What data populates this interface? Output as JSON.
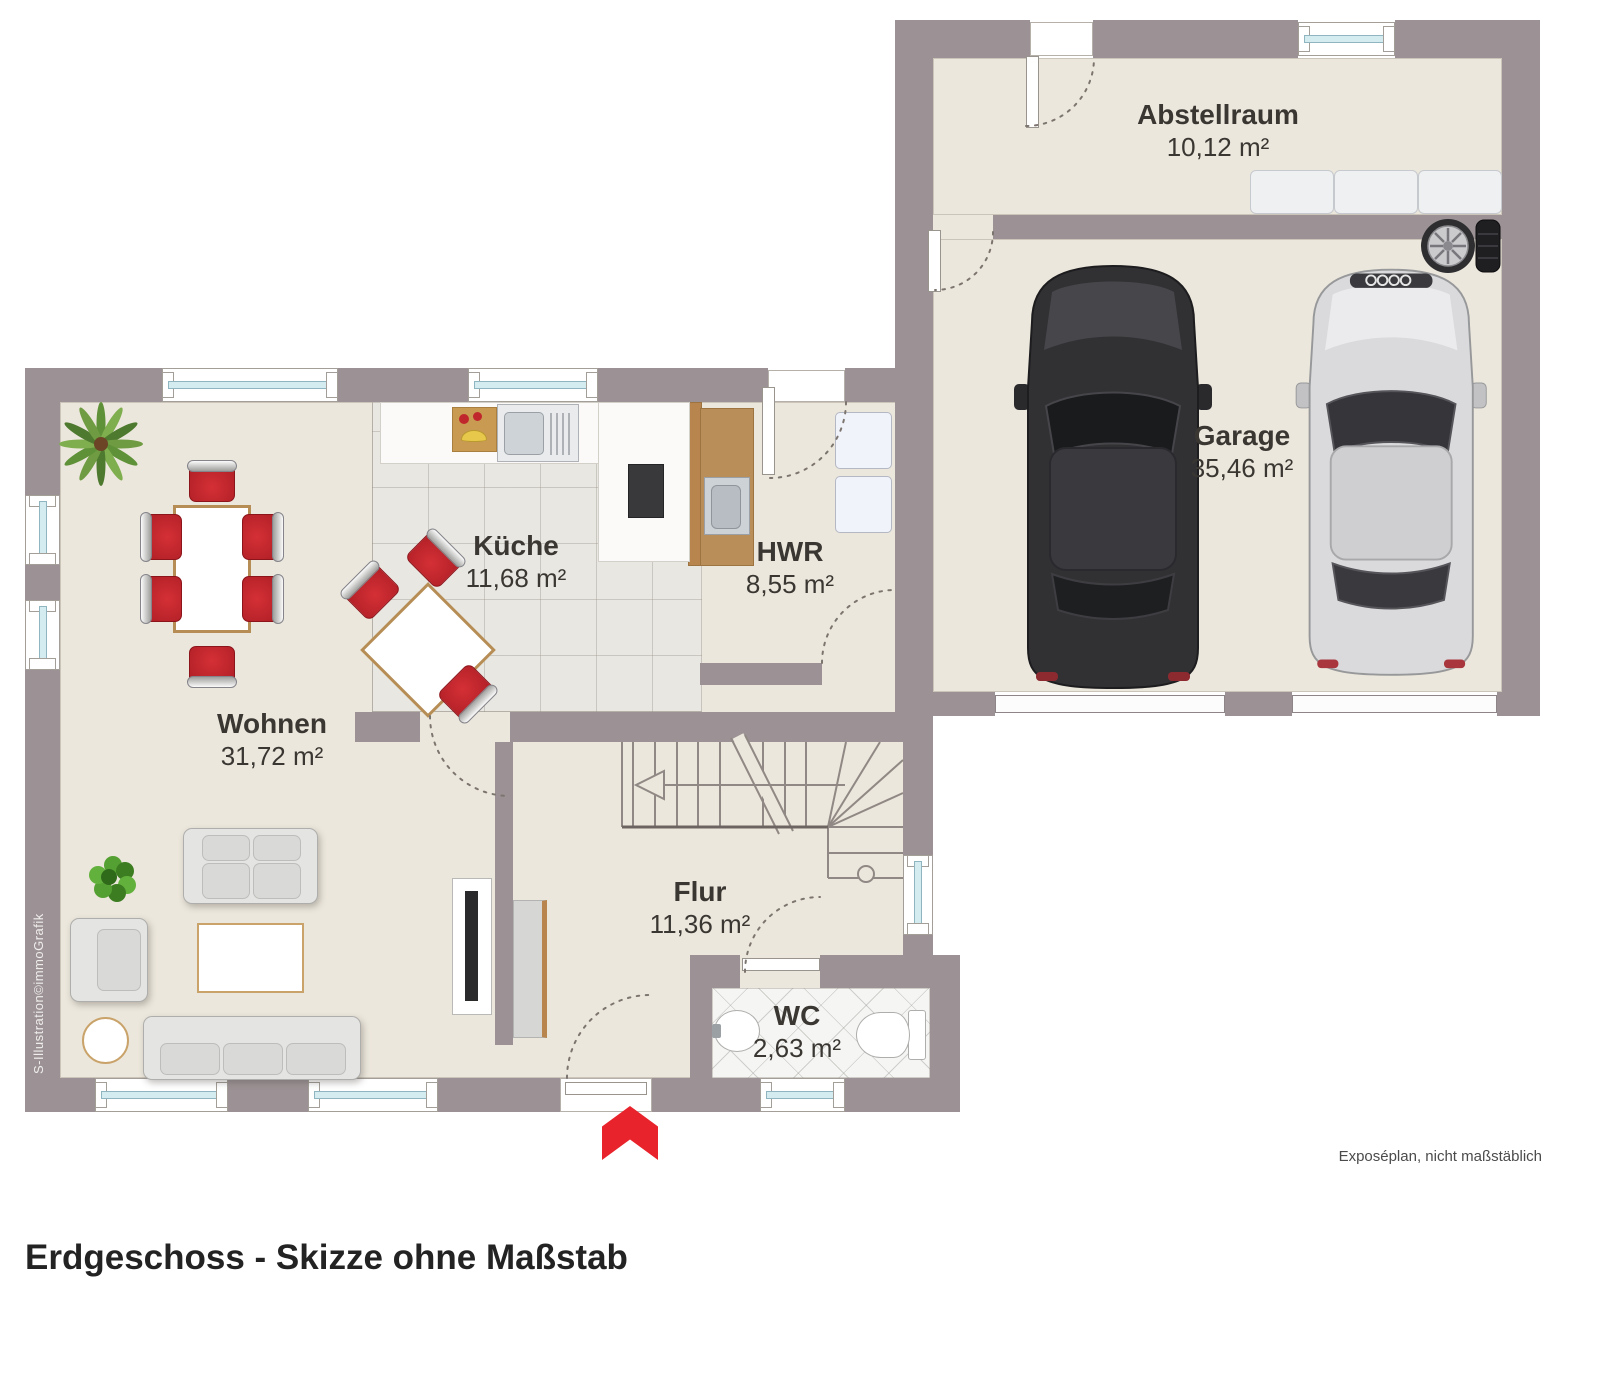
{
  "meta": {
    "title": "Erdgeschoss - Skizze ohne Maßstab",
    "footer_note": "Exposéplan, nicht maßstäblich",
    "watermark": "S-Illustration©immoGrafik"
  },
  "rooms": [
    {
      "name": "Abstellraum",
      "area": "10,12 m²"
    },
    {
      "name": "Garage",
      "area": "35,46 m²"
    },
    {
      "name": "Küche",
      "area": "11,68 m²"
    },
    {
      "name": "HWR",
      "area": "8,55 m²"
    },
    {
      "name": "Wohnen",
      "area": "31,72 m²"
    },
    {
      "name": "Flur",
      "area": "11,36 m²"
    },
    {
      "name": "WC",
      "area": "2,63 m²"
    }
  ],
  "icons": {
    "entrance_arrow": "chevron-up"
  },
  "colors": {
    "wall": "#9c9295",
    "floor": "#ece7dc",
    "accent_red": "#e8232b",
    "window_glass": "#d4ebf0"
  }
}
